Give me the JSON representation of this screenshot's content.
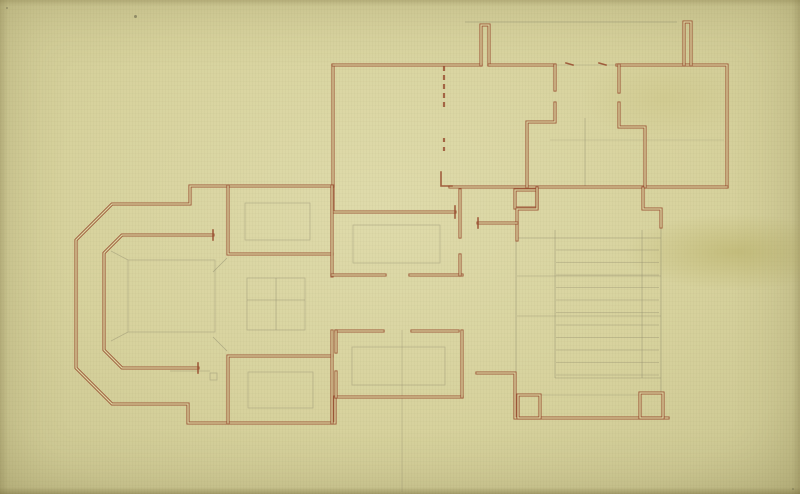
{
  "meta": {
    "kind": "architectural floor plan, hand drawn ink and pencil on aged paper",
    "canvas": {
      "w": 800,
      "h": 494
    }
  },
  "palette": {
    "paper": "#d7d29d",
    "paper_light": "#dfdbab",
    "paper_mid": "#cfca95",
    "paper_edge": "#c0bb86",
    "stain": "rgba(181,172,99,0.55)",
    "ink": "#96492c",
    "ink_light": "#bd7c50",
    "gap": "#dcd7a3",
    "pencil": "#8d8a6c"
  },
  "drawing": {
    "double_walls": [
      {
        "pts": [
          [
            333,
            65
          ],
          [
            333,
            212
          ],
          [
            455,
            212
          ]
        ]
      },
      {
        "pts": [
          [
            333,
            65
          ],
          [
            481,
            65
          ]
        ]
      },
      {
        "pts": [
          [
            481,
            65
          ],
          [
            481,
            25
          ],
          [
            489,
            25
          ],
          [
            489,
            65
          ]
        ]
      },
      {
        "pts": [
          [
            489,
            65
          ],
          [
            553,
            65
          ]
        ]
      },
      {
        "pts": [
          [
            617,
            65
          ],
          [
            727,
            65
          ],
          [
            727,
            187
          ]
        ]
      },
      {
        "pts": [
          [
            684,
            65
          ],
          [
            684,
            22
          ],
          [
            691,
            22
          ],
          [
            691,
            65
          ]
        ]
      },
      {
        "pts": [
          [
            450,
            187
          ],
          [
            727,
            187
          ]
        ]
      },
      {
        "pts": [
          [
            555,
            65
          ],
          [
            555,
            90
          ]
        ]
      },
      {
        "pts": [
          [
            555,
            103
          ],
          [
            555,
            122
          ],
          [
            527,
            122
          ],
          [
            527,
            187
          ]
        ]
      },
      {
        "pts": [
          [
            619,
            65
          ],
          [
            619,
            92
          ]
        ]
      },
      {
        "pts": [
          [
            619,
            103
          ],
          [
            619,
            127
          ],
          [
            645,
            127
          ],
          [
            645,
            187
          ]
        ]
      },
      {
        "pts": [
          [
            515,
            190
          ],
          [
            537,
            190
          ],
          [
            537,
            208
          ],
          [
            515,
            208
          ],
          [
            515,
            190
          ]
        ]
      },
      {
        "pts": [
          [
            643,
            188
          ],
          [
            643,
            209
          ],
          [
            661,
            209
          ],
          [
            661,
            227
          ]
        ]
      },
      {
        "pts": [
          [
            537,
            188
          ],
          [
            537,
            209
          ],
          [
            517,
            209
          ],
          [
            517,
            240
          ]
        ]
      },
      {
        "pts": [
          [
            478,
            223
          ],
          [
            517,
            223
          ]
        ]
      },
      {
        "pts": [
          [
            333,
            186
          ],
          [
            190,
            186
          ],
          [
            190,
            204
          ],
          [
            112,
            204
          ],
          [
            76,
            240
          ],
          [
            76,
            368
          ],
          [
            112,
            404
          ],
          [
            188,
            404
          ],
          [
            188,
            423
          ],
          [
            335,
            423
          ],
          [
            335,
            397
          ],
          [
            462,
            397
          ]
        ]
      },
      {
        "pts": [
          [
            462,
            397
          ],
          [
            462,
            331
          ]
        ]
      },
      {
        "pts": [
          [
            477,
            373
          ],
          [
            515,
            373
          ],
          [
            515,
            418
          ],
          [
            668,
            418
          ]
        ]
      },
      {
        "pts": [
          [
            518,
            395
          ],
          [
            540,
            395
          ],
          [
            540,
            418
          ],
          [
            518,
            418
          ],
          [
            518,
            395
          ]
        ]
      },
      {
        "pts": [
          [
            640,
            393
          ],
          [
            663,
            393
          ],
          [
            663,
            418
          ],
          [
            640,
            418
          ],
          [
            640,
            393
          ]
        ]
      },
      {
        "pts": [
          [
            228,
            186
          ],
          [
            228,
            254
          ],
          [
            332,
            254
          ]
        ]
      },
      {
        "pts": [
          [
            332,
            186
          ],
          [
            332,
            276
          ]
        ]
      },
      {
        "pts": [
          [
            228,
            423
          ],
          [
            228,
            356
          ],
          [
            332,
            356
          ]
        ]
      },
      {
        "pts": [
          [
            332,
            423
          ],
          [
            332,
            331
          ]
        ]
      },
      {
        "pts": [
          [
            213,
            235
          ],
          [
            122,
            235
          ],
          [
            104,
            253
          ],
          [
            104,
            350
          ],
          [
            122,
            368
          ],
          [
            198,
            368
          ]
        ]
      },
      {
        "pts": [
          [
            332,
            275
          ],
          [
            385,
            275
          ]
        ]
      },
      {
        "pts": [
          [
            410,
            275
          ],
          [
            462,
            275
          ]
        ]
      },
      {
        "pts": [
          [
            336,
            331
          ],
          [
            383,
            331
          ]
        ]
      },
      {
        "pts": [
          [
            412,
            331
          ],
          [
            458,
            331
          ]
        ]
      },
      {
        "pts": [
          [
            336,
            331
          ],
          [
            336,
            352
          ]
        ]
      },
      {
        "pts": [
          [
            336,
            372
          ],
          [
            336,
            397
          ]
        ]
      },
      {
        "pts": [
          [
            460,
            190
          ],
          [
            460,
            237
          ]
        ]
      },
      {
        "pts": [
          [
            460,
            255
          ],
          [
            460,
            275
          ]
        ]
      }
    ],
    "single_walls": [
      {
        "pts": [
          [
            441,
            172
          ],
          [
            441,
            186
          ],
          [
            452,
            186
          ]
        ]
      },
      {
        "pts": [
          [
            455,
            206
          ],
          [
            455,
            218
          ]
        ]
      },
      {
        "pts": [
          [
            213,
            230
          ],
          [
            213,
            240
          ]
        ]
      },
      {
        "pts": [
          [
            198,
            363
          ],
          [
            198,
            373
          ]
        ]
      },
      {
        "pts": [
          [
            478,
            218
          ],
          [
            478,
            228
          ]
        ]
      },
      {
        "pts": [
          [
            566,
            63
          ],
          [
            573,
            65
          ]
        ]
      },
      {
        "pts": [
          [
            599,
            63
          ],
          [
            606,
            65
          ]
        ]
      }
    ],
    "dashed_walls": [
      {
        "pts": [
          [
            444,
            66
          ],
          [
            444,
            110
          ]
        ],
        "dash": "5 4"
      },
      {
        "pts": [
          [
            444,
            138
          ],
          [
            444,
            144
          ]
        ],
        "dash": "4 3"
      },
      {
        "pts": [
          [
            444,
            147
          ],
          [
            444,
            153
          ]
        ],
        "dash": "4 3"
      }
    ],
    "pencil_lines": [
      {
        "pts": [
          [
            465,
            22
          ],
          [
            677,
            22
          ]
        ],
        "o": 0.55
      },
      {
        "pts": [
          [
            553,
            65
          ],
          [
            617,
            65
          ]
        ],
        "o": 0.4
      },
      {
        "pts": [
          [
            585,
            118
          ],
          [
            585,
            186
          ]
        ],
        "o": 0.5
      },
      {
        "pts": [
          [
            550,
            140
          ],
          [
            724,
            140
          ]
        ],
        "o": 0.3
      },
      {
        "pts": [
          [
            516,
            240
          ],
          [
            516,
            372
          ]
        ],
        "o": 0.55
      },
      {
        "pts": [
          [
            555,
            230
          ],
          [
            555,
            378
          ]
        ],
        "o": 0.5
      },
      {
        "pts": [
          [
            642,
            230
          ],
          [
            642,
            378
          ]
        ],
        "o": 0.5
      },
      {
        "pts": [
          [
            661,
            227
          ],
          [
            661,
            393
          ]
        ],
        "o": 0.55
      },
      {
        "pts": [
          [
            517,
            238
          ],
          [
            661,
            238
          ]
        ],
        "o": 0.5
      },
      {
        "pts": [
          [
            517,
            276
          ],
          [
            661,
            276
          ]
        ],
        "o": 0.45
      },
      {
        "pts": [
          [
            517,
            316
          ],
          [
            661,
            316
          ]
        ],
        "o": 0.45
      },
      {
        "pts": [
          [
            555,
            378
          ],
          [
            661,
            378
          ]
        ],
        "o": 0.45
      },
      {
        "pts": [
          [
            540,
            395
          ],
          [
            640,
            395
          ]
        ],
        "o": 0.4
      },
      {
        "pts": [
          [
            213,
            272
          ],
          [
            227,
            258
          ]
        ],
        "o": 0.55
      },
      {
        "pts": [
          [
            213,
            337
          ],
          [
            227,
            351
          ]
        ],
        "o": 0.55
      },
      {
        "pts": [
          [
            170,
            371
          ],
          [
            210,
            371
          ]
        ],
        "o": 0.45
      },
      {
        "pts": [
          [
            128,
            260
          ],
          [
            111,
            251
          ]
        ],
        "o": 0.45
      },
      {
        "pts": [
          [
            128,
            332
          ],
          [
            111,
            341
          ]
        ],
        "o": 0.45
      },
      {
        "pts": [
          [
            276,
            278
          ],
          [
            276,
            330
          ]
        ],
        "o": 0.5
      },
      {
        "pts": [
          [
            247,
            300
          ],
          [
            305,
            300
          ]
        ],
        "o": 0.5
      },
      {
        "pts": [
          [
            402,
            330
          ],
          [
            402,
            492
          ]
        ],
        "o": 0.14,
        "w": 2
      }
    ],
    "pencil_rects": [
      {
        "x": 245,
        "y": 203,
        "w": 65,
        "h": 37
      },
      {
        "x": 248,
        "y": 372,
        "w": 65,
        "h": 36
      },
      {
        "x": 353,
        "y": 225,
        "w": 87,
        "h": 38
      },
      {
        "x": 352,
        "y": 347,
        "w": 93,
        "h": 38
      },
      {
        "x": 128,
        "y": 260,
        "w": 87,
        "h": 72
      },
      {
        "x": 247,
        "y": 278,
        "w": 58,
        "h": 52
      },
      {
        "x": 210,
        "y": 373,
        "w": 7,
        "h": 7
      }
    ],
    "stair_treads": {
      "x1": 556,
      "x2": 659,
      "y_start": 250,
      "step": 12.5,
      "count": 11,
      "o": 0.45
    },
    "specks": [
      {
        "x": 135,
        "y": 16,
        "r": 1.5,
        "o": 0.45
      },
      {
        "x": 7,
        "y": 8,
        "r": 1.2,
        "o": 0.35
      },
      {
        "x": 793,
        "y": 489,
        "r": 1.2,
        "o": 0.3
      }
    ]
  }
}
